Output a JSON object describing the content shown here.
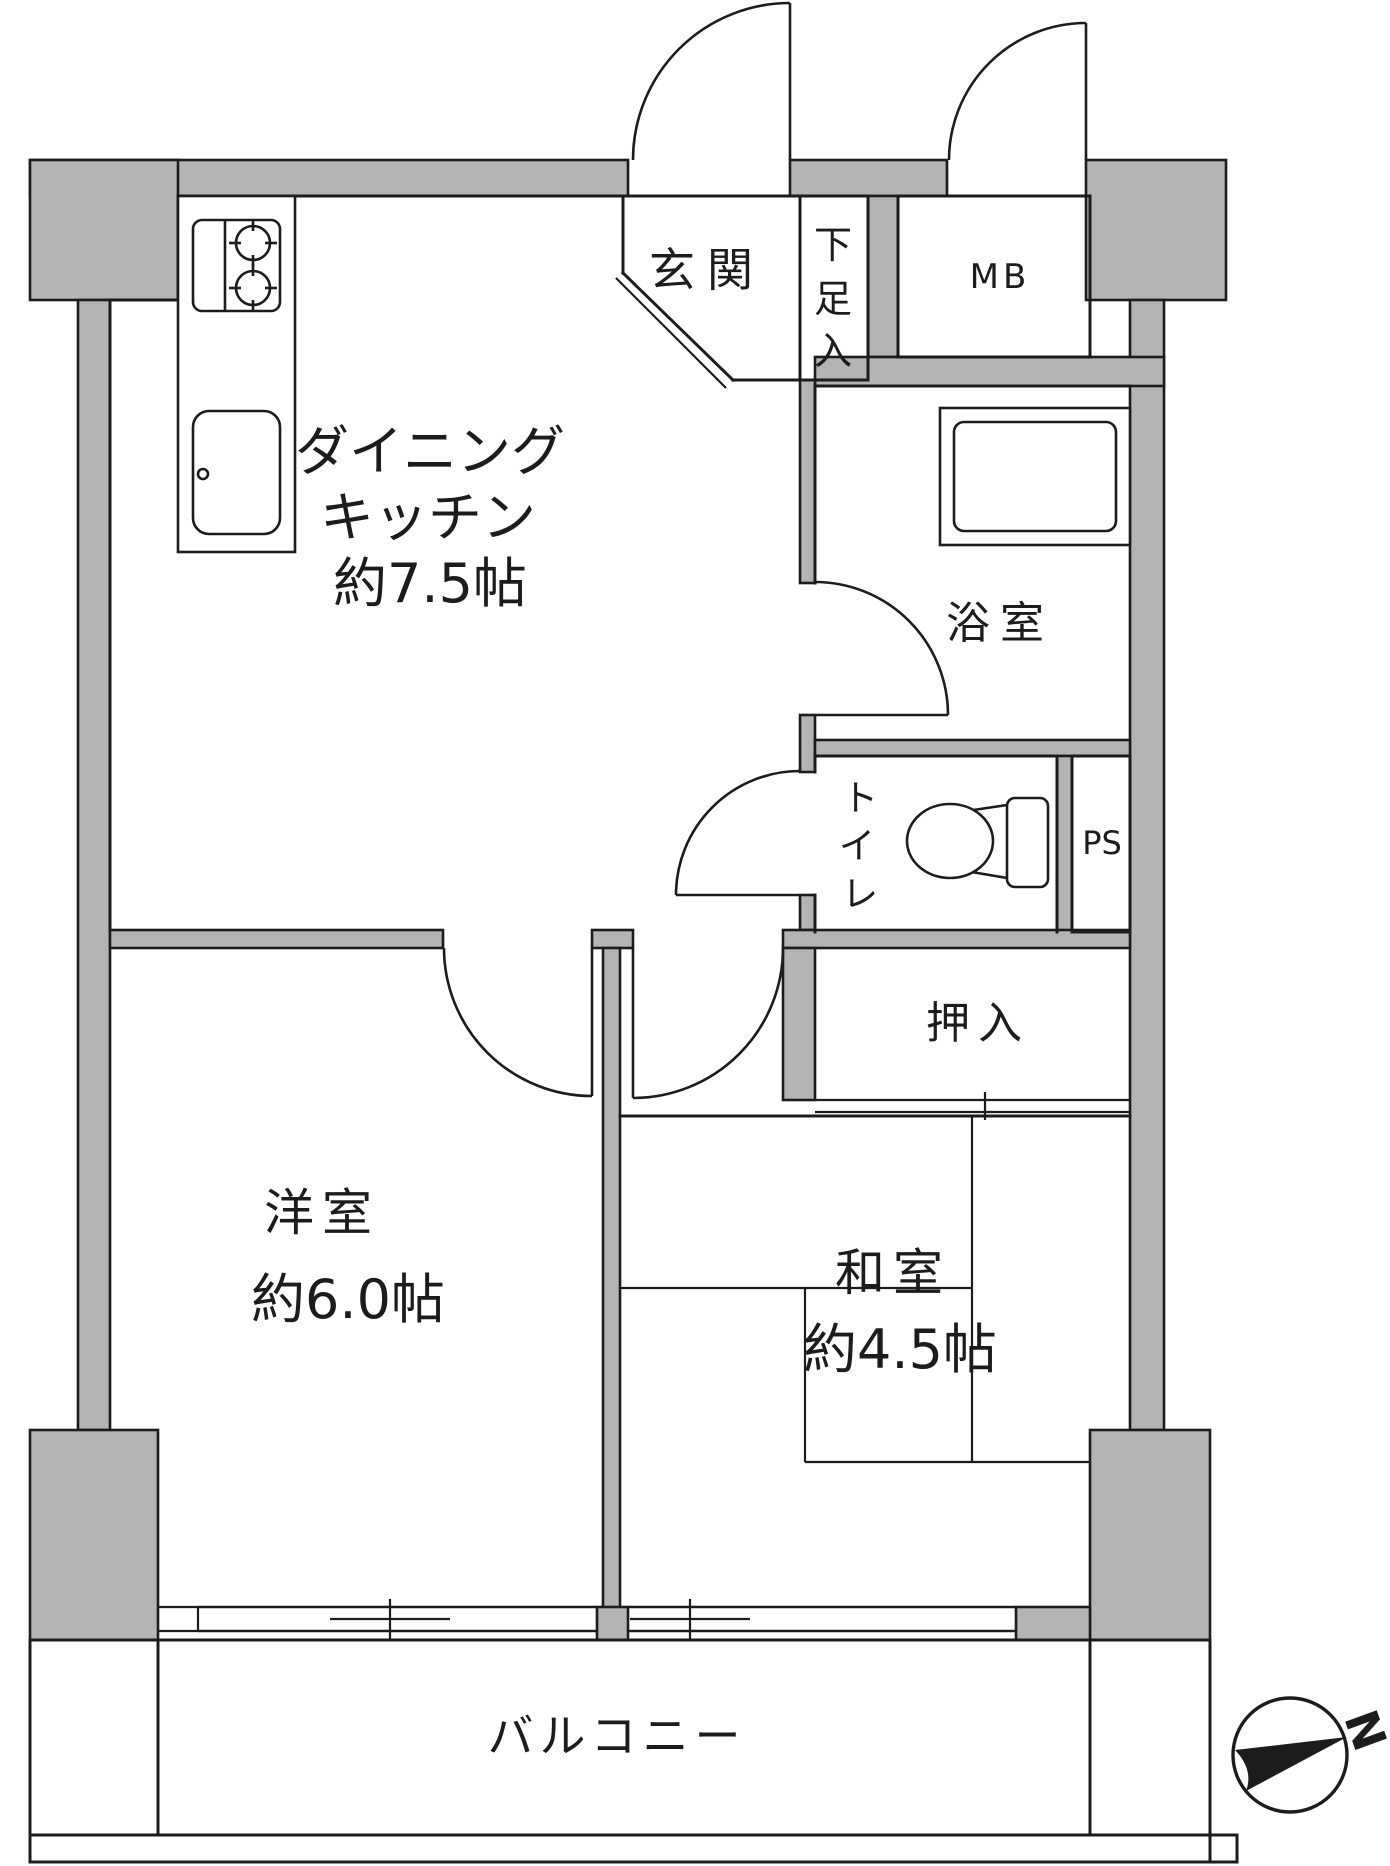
{
  "plan": {
    "type": "apartment-floor-plan",
    "rooms": {
      "dining_kitchen": {
        "label_line1": "ダイニング",
        "label_line2": "キッチン",
        "size": "約7.5帖"
      },
      "entrance": {
        "label": "玄関"
      },
      "shoe_storage": {
        "chars": [
          "下",
          "足",
          "入"
        ]
      },
      "meter_box": {
        "label": "MB"
      },
      "bathroom": {
        "label": "浴室"
      },
      "toilet": {
        "chars": [
          "ト",
          "イ",
          "レ"
        ]
      },
      "pipe_space": {
        "label": "PS"
      },
      "closet": {
        "label": "押入"
      },
      "western_room": {
        "label": "洋室",
        "size": "約6.0帖"
      },
      "japanese_room": {
        "label": "和室",
        "size": "約4.5帖"
      },
      "balcony": {
        "label": "バルコニー"
      }
    },
    "compass": {
      "label": "N"
    },
    "colors": {
      "wall_fill": "#b4b4b4",
      "line": "#1c1c1c",
      "background": "#ffffff"
    }
  }
}
